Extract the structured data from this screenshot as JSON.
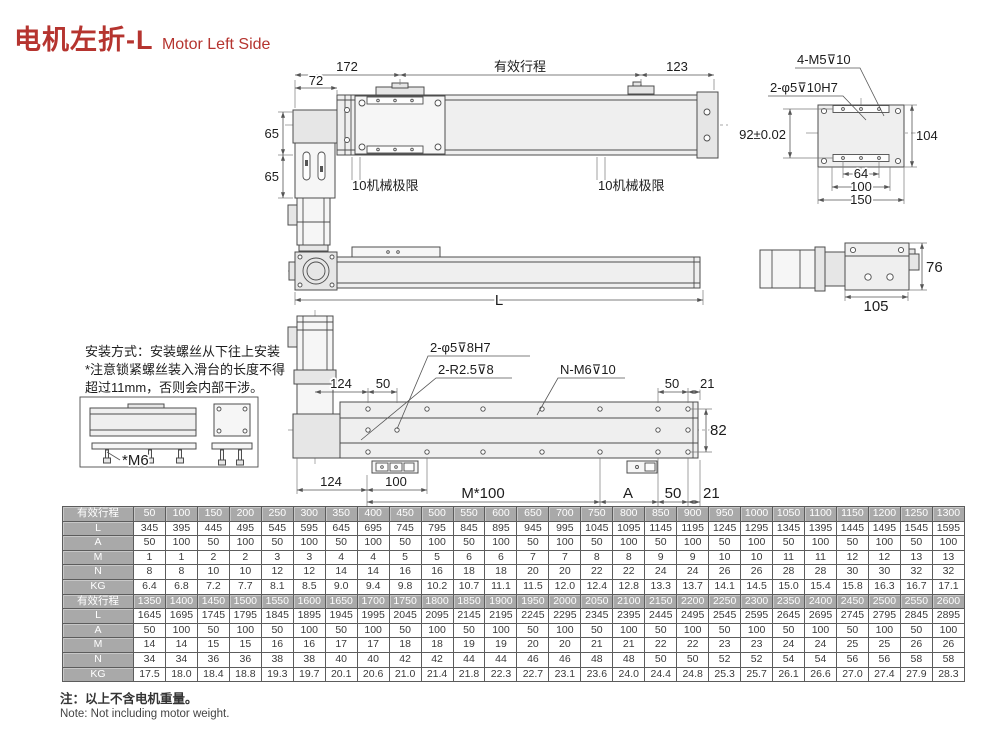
{
  "title": {
    "zh": "电机左折-L",
    "en": "Motor Left Side"
  },
  "drawings": {
    "top_view": {
      "d172": "172",
      "stroke_label": "有效行程",
      "d123": "123",
      "d72": "72",
      "d65a": "65",
      "d65b": "65",
      "limit_l": "10机械极限",
      "limit_r": "10机械极限"
    },
    "plate": {
      "a_m5": "4-M5⊽10",
      "a_h7": "2-φ5⊽10H7",
      "d92": "92±0.02",
      "d104": "104",
      "d64": "64",
      "d100": "100",
      "d150": "150"
    },
    "side": {
      "dL": "L"
    },
    "end": {
      "d76": "76",
      "d105": "105"
    },
    "mount": {
      "l1": "安装方式：安装螺丝从下往上安装",
      "l2": "*注意锁紧螺丝装入滑台的长度不得",
      "l3": "超过11mm，否则会内部干涉。",
      "m6": "*M6"
    },
    "bottom": {
      "a_phi": "2-φ5⊽8H7",
      "a_r": "2-R2.5⊽8",
      "a_nm6": "N-M6⊽10",
      "d124t": "124",
      "d50t": "50",
      "d50tr": "50",
      "d21tr": "21",
      "d82": "82",
      "d124b": "124",
      "d100b": "100",
      "dm100": "M*100",
      "dA": "A",
      "d50b": "50",
      "d21b": "21"
    }
  },
  "table": {
    "blocks": [
      {
        "rows": [
          {
            "label": "有效行程",
            "values": [
              "50",
              "100",
              "150",
              "200",
              "250",
              "300",
              "350",
              "400",
              "450",
              "500",
              "550",
              "600",
              "650",
              "700",
              "750",
              "800",
              "850",
              "900",
              "950",
              "1000",
              "1050",
              "1100",
              "1150",
              "1200",
              "1250",
              "1300"
            ]
          },
          {
            "label": "L",
            "values": [
              "345",
              "395",
              "445",
              "495",
              "545",
              "595",
              "645",
              "695",
              "745",
              "795",
              "845",
              "895",
              "945",
              "995",
              "1045",
              "1095",
              "1145",
              "1195",
              "1245",
              "1295",
              "1345",
              "1395",
              "1445",
              "1495",
              "1545",
              "1595"
            ]
          },
          {
            "label": "A",
            "values": [
              "50",
              "100",
              "50",
              "100",
              "50",
              "100",
              "50",
              "100",
              "50",
              "100",
              "50",
              "100",
              "50",
              "100",
              "50",
              "100",
              "50",
              "100",
              "50",
              "100",
              "50",
              "100",
              "50",
              "100",
              "50",
              "100"
            ]
          },
          {
            "label": "M",
            "values": [
              "1",
              "1",
              "2",
              "2",
              "3",
              "3",
              "4",
              "4",
              "5",
              "5",
              "6",
              "6",
              "7",
              "7",
              "8",
              "8",
              "9",
              "9",
              "10",
              "10",
              "11",
              "11",
              "12",
              "12",
              "13",
              "13"
            ]
          },
          {
            "label": "N",
            "values": [
              "8",
              "8",
              "10",
              "10",
              "12",
              "12",
              "14",
              "14",
              "16",
              "16",
              "18",
              "18",
              "20",
              "20",
              "22",
              "22",
              "24",
              "24",
              "26",
              "26",
              "28",
              "28",
              "30",
              "30",
              "32",
              "32"
            ]
          },
          {
            "label": "KG",
            "values": [
              "6.4",
              "6.8",
              "7.2",
              "7.7",
              "8.1",
              "8.5",
              "9.0",
              "9.4",
              "9.8",
              "10.2",
              "10.7",
              "11.1",
              "11.5",
              "12.0",
              "12.4",
              "12.8",
              "13.3",
              "13.7",
              "14.1",
              "14.5",
              "15.0",
              "15.4",
              "15.8",
              "16.3",
              "16.7",
              "17.1"
            ]
          }
        ]
      },
      {
        "rows": [
          {
            "label": "有效行程",
            "values": [
              "1350",
              "1400",
              "1450",
              "1500",
              "1550",
              "1600",
              "1650",
              "1700",
              "1750",
              "1800",
              "1850",
              "1900",
              "1950",
              "2000",
              "2050",
              "2100",
              "2150",
              "2200",
              "2250",
              "2300",
              "2350",
              "2400",
              "2450",
              "2500",
              "2550",
              "2600"
            ]
          },
          {
            "label": "L",
            "values": [
              "1645",
              "1695",
              "1745",
              "1795",
              "1845",
              "1895",
              "1945",
              "1995",
              "2045",
              "2095",
              "2145",
              "2195",
              "2245",
              "2295",
              "2345",
              "2395",
              "2445",
              "2495",
              "2545",
              "2595",
              "2645",
              "2695",
              "2745",
              "2795",
              "2845",
              "2895"
            ]
          },
          {
            "label": "A",
            "values": [
              "50",
              "100",
              "50",
              "100",
              "50",
              "100",
              "50",
              "100",
              "50",
              "100",
              "50",
              "100",
              "50",
              "100",
              "50",
              "100",
              "50",
              "100",
              "50",
              "100",
              "50",
              "100",
              "50",
              "100",
              "50",
              "100"
            ]
          },
          {
            "label": "M",
            "values": [
              "14",
              "14",
              "15",
              "15",
              "16",
              "16",
              "17",
              "17",
              "18",
              "18",
              "19",
              "19",
              "20",
              "20",
              "21",
              "21",
              "22",
              "22",
              "23",
              "23",
              "24",
              "24",
              "25",
              "25",
              "26",
              "26"
            ]
          },
          {
            "label": "N",
            "values": [
              "34",
              "34",
              "36",
              "36",
              "38",
              "38",
              "40",
              "40",
              "42",
              "42",
              "44",
              "44",
              "46",
              "46",
              "48",
              "48",
              "50",
              "50",
              "52",
              "52",
              "54",
              "54",
              "56",
              "56",
              "58",
              "58"
            ]
          },
          {
            "label": "KG",
            "values": [
              "17.5",
              "18.0",
              "18.4",
              "18.8",
              "19.3",
              "19.7",
              "20.1",
              "20.6",
              "21.0",
              "21.4",
              "21.8",
              "22.3",
              "22.7",
              "23.1",
              "23.6",
              "24.0",
              "24.4",
              "24.8",
              "25.3",
              "25.7",
              "26.1",
              "26.6",
              "27.0",
              "27.4",
              "27.9",
              "28.3"
            ]
          }
        ]
      }
    ]
  },
  "notes": {
    "zh": "注：以上不含电机重量。",
    "en": "Note: Not including motor weight."
  }
}
